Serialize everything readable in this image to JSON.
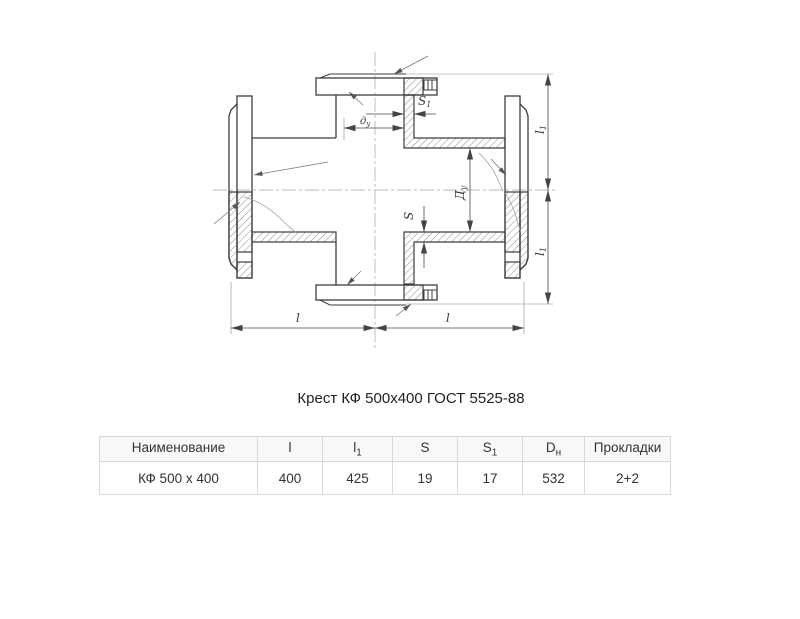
{
  "title": "Крест КФ 500х400 ГОСТ 5525-88",
  "drawing": {
    "dims": {
      "l_left": {
        "main": "l",
        "sub": ""
      },
      "l_right": {
        "main": "l",
        "sub": ""
      },
      "l1_top": {
        "main": "l",
        "sub": "1"
      },
      "l1_bottom": {
        "main": "l",
        "sub": "1"
      },
      "Du_run": {
        "main": "Д",
        "sub": "у"
      },
      "du_branch": {
        "main": "д",
        "sub": "у"
      },
      "S_run": {
        "main": "S",
        "sub": ""
      },
      "S1_branch": {
        "main": "S",
        "sub": "1"
      }
    }
  },
  "table": {
    "columns": [
      {
        "label": "Наименование",
        "sub": ""
      },
      {
        "label": "l",
        "sub": ""
      },
      {
        "label": "l",
        "sub": "1"
      },
      {
        "label": "S",
        "sub": ""
      },
      {
        "label": "S",
        "sub": "1"
      },
      {
        "label": "D",
        "sub": "н"
      },
      {
        "label": "Прокладки",
        "sub": ""
      }
    ],
    "rows": [
      {
        "cells": [
          {
            "text": "КФ 500 х 400"
          },
          {
            "text": "400"
          },
          {
            "text": "425"
          },
          {
            "text": "19"
          },
          {
            "text": "17"
          },
          {
            "text": "532"
          },
          {
            "text": "2+2"
          }
        ]
      }
    ]
  }
}
